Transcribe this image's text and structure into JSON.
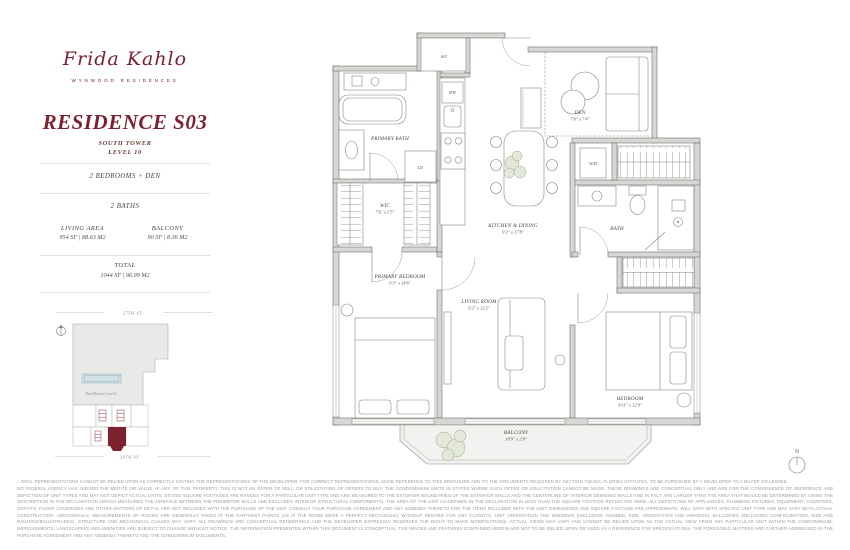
{
  "brand": {
    "logo_script": "Frida Kahlo",
    "logo_subtitle": "WYNWOOD RESIDENCES"
  },
  "residence": {
    "title": "RESIDENCE S03",
    "tower": "SOUTH TOWER",
    "level": "LEVEL 10",
    "bedrooms": "2 BEDROOMS + DEN",
    "baths": "2 BATHS",
    "living_area_label": "LIVING AREA",
    "living_area_value": "954 SF | 88.63 M2",
    "balcony_label": "BALCONY",
    "balcony_value": "90 SF | 8.36 M2",
    "total_label": "TOTAL",
    "total_value": "1044 SF | 96.99 M2"
  },
  "keyplan": {
    "street_top": "27TH ST.",
    "street_bottom": "26TH ST.",
    "pool_label": "Pool Deck on Level 4"
  },
  "floorplan": {
    "rooms": {
      "primary_bath": {
        "name": "PRIMARY BATH"
      },
      "wic": {
        "name": "WIC",
        "dims": "7'6\" x 5'5\""
      },
      "den": {
        "name": "DEN",
        "dims": "7'6\" x 7'4\""
      },
      "kitchen_dining": {
        "name": "KITCHEN & DINING",
        "dims": "9'2\" x 17'8\""
      },
      "primary_bedroom": {
        "name": "PRIMARY BEDROOM",
        "dims": "9'3\" x 14'6\""
      },
      "living_room": {
        "name": "LIVING ROOM",
        "dims": "9'2\" x 12'2\""
      },
      "bath": {
        "name": "BATH"
      },
      "bedroom": {
        "name": "BEDROOM",
        "dims": "9'11\" x 12'9\""
      },
      "balcony": {
        "name": "BALCONY",
        "dims": "18'9\" x 2'9\""
      }
    },
    "labels": {
      "ac": "A/C",
      "dw": "DW",
      "ln": "LN",
      "wd": "W/D"
    }
  },
  "compass": {
    "north": "N"
  },
  "disclaimer": {
    "p1": "ORAL REPRESENTATIONS CANNOT BE RELIED UPON AS CORRECTLY STATING THE REPRESENTATIONS OF THE DEVELOPER. FOR CORRECT REPRESENTATIONS, MAKE REFERENCE TO THIS BROCHURE AND TO THE DOCUMENTS REQUIRED BY SECTION 718.503, FLORIDA STATUTES, TO BE FURNISHED BY A DEVELOPER TO A BUYER OR LESSEE.",
    "p2": "NO FEDERAL AGENCY HAS JUDGED THE MERITS OR VALUE, IF ANY, OF THIS PROPERTY. THIS IS NOT AN OFFER TO SELL, OR SOLICITATION OF OFFERS TO BUY, THE CONDOMINIUM UNITS IN STATES WHERE SUCH OFFER OR SOLICITATION CANNOT BE MADE. THESE DRAWINGS ARE CONCEPTUAL ONLY AND ARE FOR THE CONVENIENCE OF REFERENCE AND DEPICTION OF UNIT TYPES AND MAY NOT DEPICT ACTUAL UNITS. STATED SQUARE FOOTAGES ARE RANGES FOR A PARTICULAR UNIT TYPE AND ARE MEASURED TO THE EXTERIOR BOUNDARIES OF THE EXTERIOR WALLS AND THE CENTERLINE OF INTERIOR DEMISING WALLS AND IN FACT ARE LARGER THAN THE AREA THAT WOULD BE DETERMINED BY USING THE DESCRIPTION IN THE DECLARATION (WHICH MEASURES THE AIRSPACE BETWEEN THE PERIMETER WALLS AND EXCLUDES INTERIOR STRUCTURAL COMPONENTS). THE AREA OF THE UNIT AS DEFINED IN THE DECLARATION IS LESS THAN THE SQUARE FOOTAGE REFLECTED HERE. ALL DEPICTIONS OF APPLIANCES, PLUMBING FIXTURES, EQUIPMENT, COUNTERS, SOFFITS, FLOOR COVERINGS AND OTHER MATTERS OF DETAIL ARE NOT INCLUDED WITH THE PURCHASE OF THE UNIT. CONSULT YOUR PURCHASE AGREEMENT AND ANY ADDENDA THERETO FOR THE ITEMS INCLUDED WITH THE UNIT. DIMENSIONS AND SQUARE FOOTAGE ARE APPROXIMATE, WILL VARY WITH SPECIFIC UNIT TYPE AND MAY VARY WITH ACTUAL CONSTRUCTION. ADDITIONALLY, MEASUREMENTS OF ROOMS ARE GENERALLY TAKEN AT THE FARTHEST POINTS (AS IF THE ROOM WERE A PERFECT RECTANGLE), WITHOUT REGARD FOR ANY CUTOUTS. UNIT ORIENTATION AND WINDOWS (INCLUDING NUMBER, SIZE, ORIENTATION AND AWNINGS), BALCONIES (INCLUDING CONFIGURATION, SIZE AND RAILINGS/BALUSTRADES), STRUCTURE AND MECHANICAL CHASES MAY VARY. ALL DRAWINGS ARE CONCEPTUAL RENDERINGS AND THE DEVELOPER EXPRESSLY RESERVES THE RIGHT TO MAKE MODIFICATIONS. ACTUAL VIEWS MAY VARY AND CANNOT BE RELIED UPON AS THE ACTUAL VIEW FROM ANY PARTICULAR UNIT WITHIN THE CONDOMINIUM. IMPROVEMENTS, LANDSCAPING AND AMENITIES ARE SUBJECT TO CHANGE WITHOUT NOTICE. THE INFORMATION PRESENTED WITHIN THIS DOCUMENT IS CONCEPTUAL. THE IMAGES AND FEATURES CONTAINED HEREIN ARE NOT TO BE RELIED UPON OR USED AS A REFERENCE FOR SPECIFICATIONS. THE FOREGOING MATTERS ARE FURTHER ADDRESSED IN THE PURCHASE AGREEMENT AND ANY ADDENDA THERETO AND THE CONDOMINIUM DOCUMENTS."
  },
  "colors": {
    "brand_maroon": "#7b2130",
    "wall_gray": "#d8d7d5",
    "pool_blue": "#cfe2e8",
    "plan_line": "#6b665f"
  }
}
